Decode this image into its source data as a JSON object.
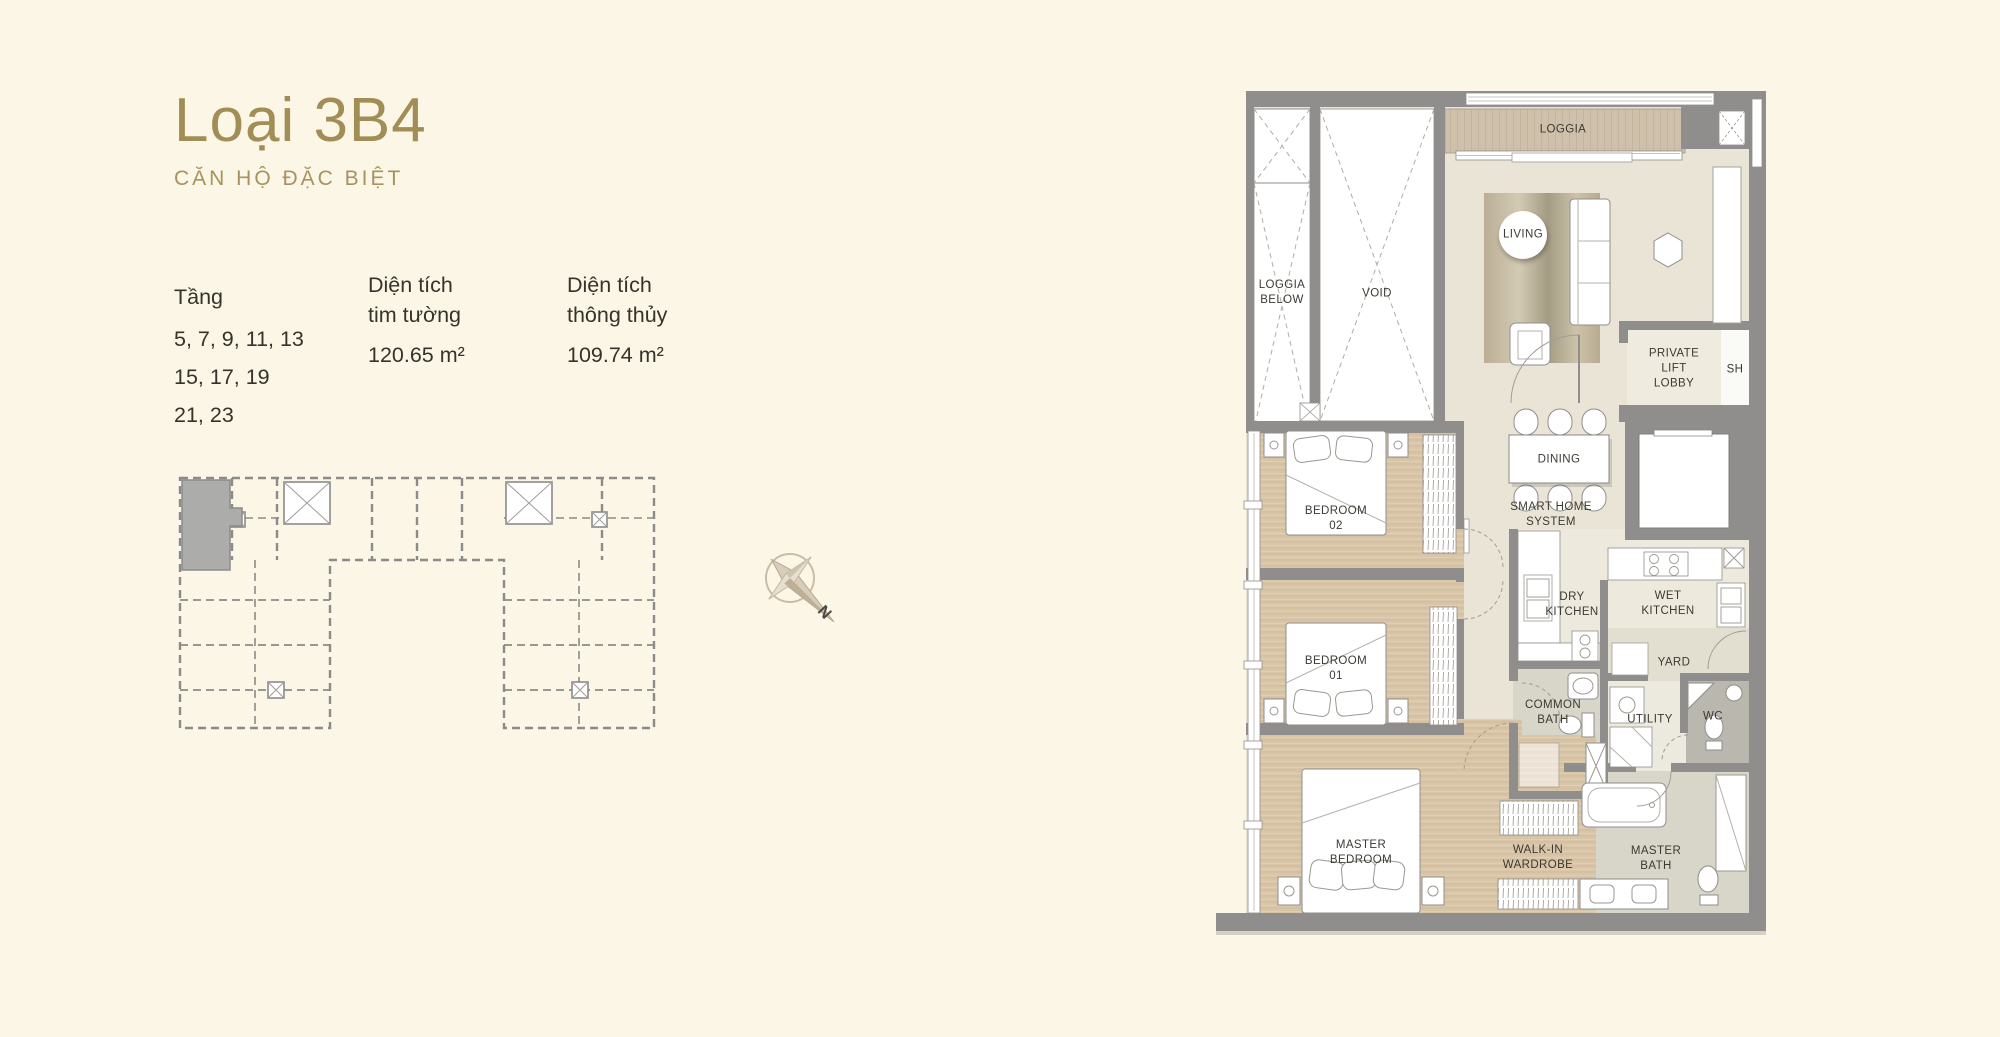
{
  "header": {
    "title": "Loại 3B4",
    "subtitle": "CĂN HỘ ĐẶC BIỆT"
  },
  "info": {
    "floors": {
      "label": "Tầng",
      "lines": [
        "5, 7, 9, 11, 13",
        "15, 17, 19",
        "21, 23"
      ]
    },
    "area_wall": {
      "label": "Diện tích\ntim tường",
      "value": "120.65 m²"
    },
    "area_net": {
      "label": "Diện tích\nthông thủy",
      "value": "109.74 m²"
    }
  },
  "compass": {
    "north": "N"
  },
  "plan": {
    "rooms": {
      "loggia": "LOGGIA",
      "loggia_below": "LOGGIA\nBELOW",
      "void": "VOID",
      "living": "LIVING",
      "private_lift_lobby": "PRIVATE\nLIFT\nLOBBY",
      "sh": "SH",
      "dining": "DINING",
      "smart_home": "SMART HOME\nSYSTEM",
      "bedroom_02": "BEDROOM\n02",
      "bedroom_01": "BEDROOM\n01",
      "dry_kitchen": "DRY\nKITCHEN",
      "wet_kitchen": "WET\nKITCHEN",
      "yard": "YARD",
      "common_bath": "COMMON\nBATH",
      "utility": "UTILITY",
      "wc": "WC",
      "master_bedroom": "MASTER\nBEDROOM",
      "walk_in_wardrobe": "WALK-IN\nWARDROBE",
      "master_bath": "MASTER\nBATH"
    }
  },
  "colors": {
    "background": "#fbf6e6",
    "accent_gold": "#a28d57",
    "text": "#35332b",
    "wall_gray": "#8f8e8c",
    "wood_floor": "#d9c5a8",
    "tile_floor": "#e9e4d6",
    "bath_floor": "#d8d6c8",
    "wc_floor": "#b9b7ae",
    "keyplan_line": "#8b8b89",
    "highlight_unit": "#acacaa"
  }
}
